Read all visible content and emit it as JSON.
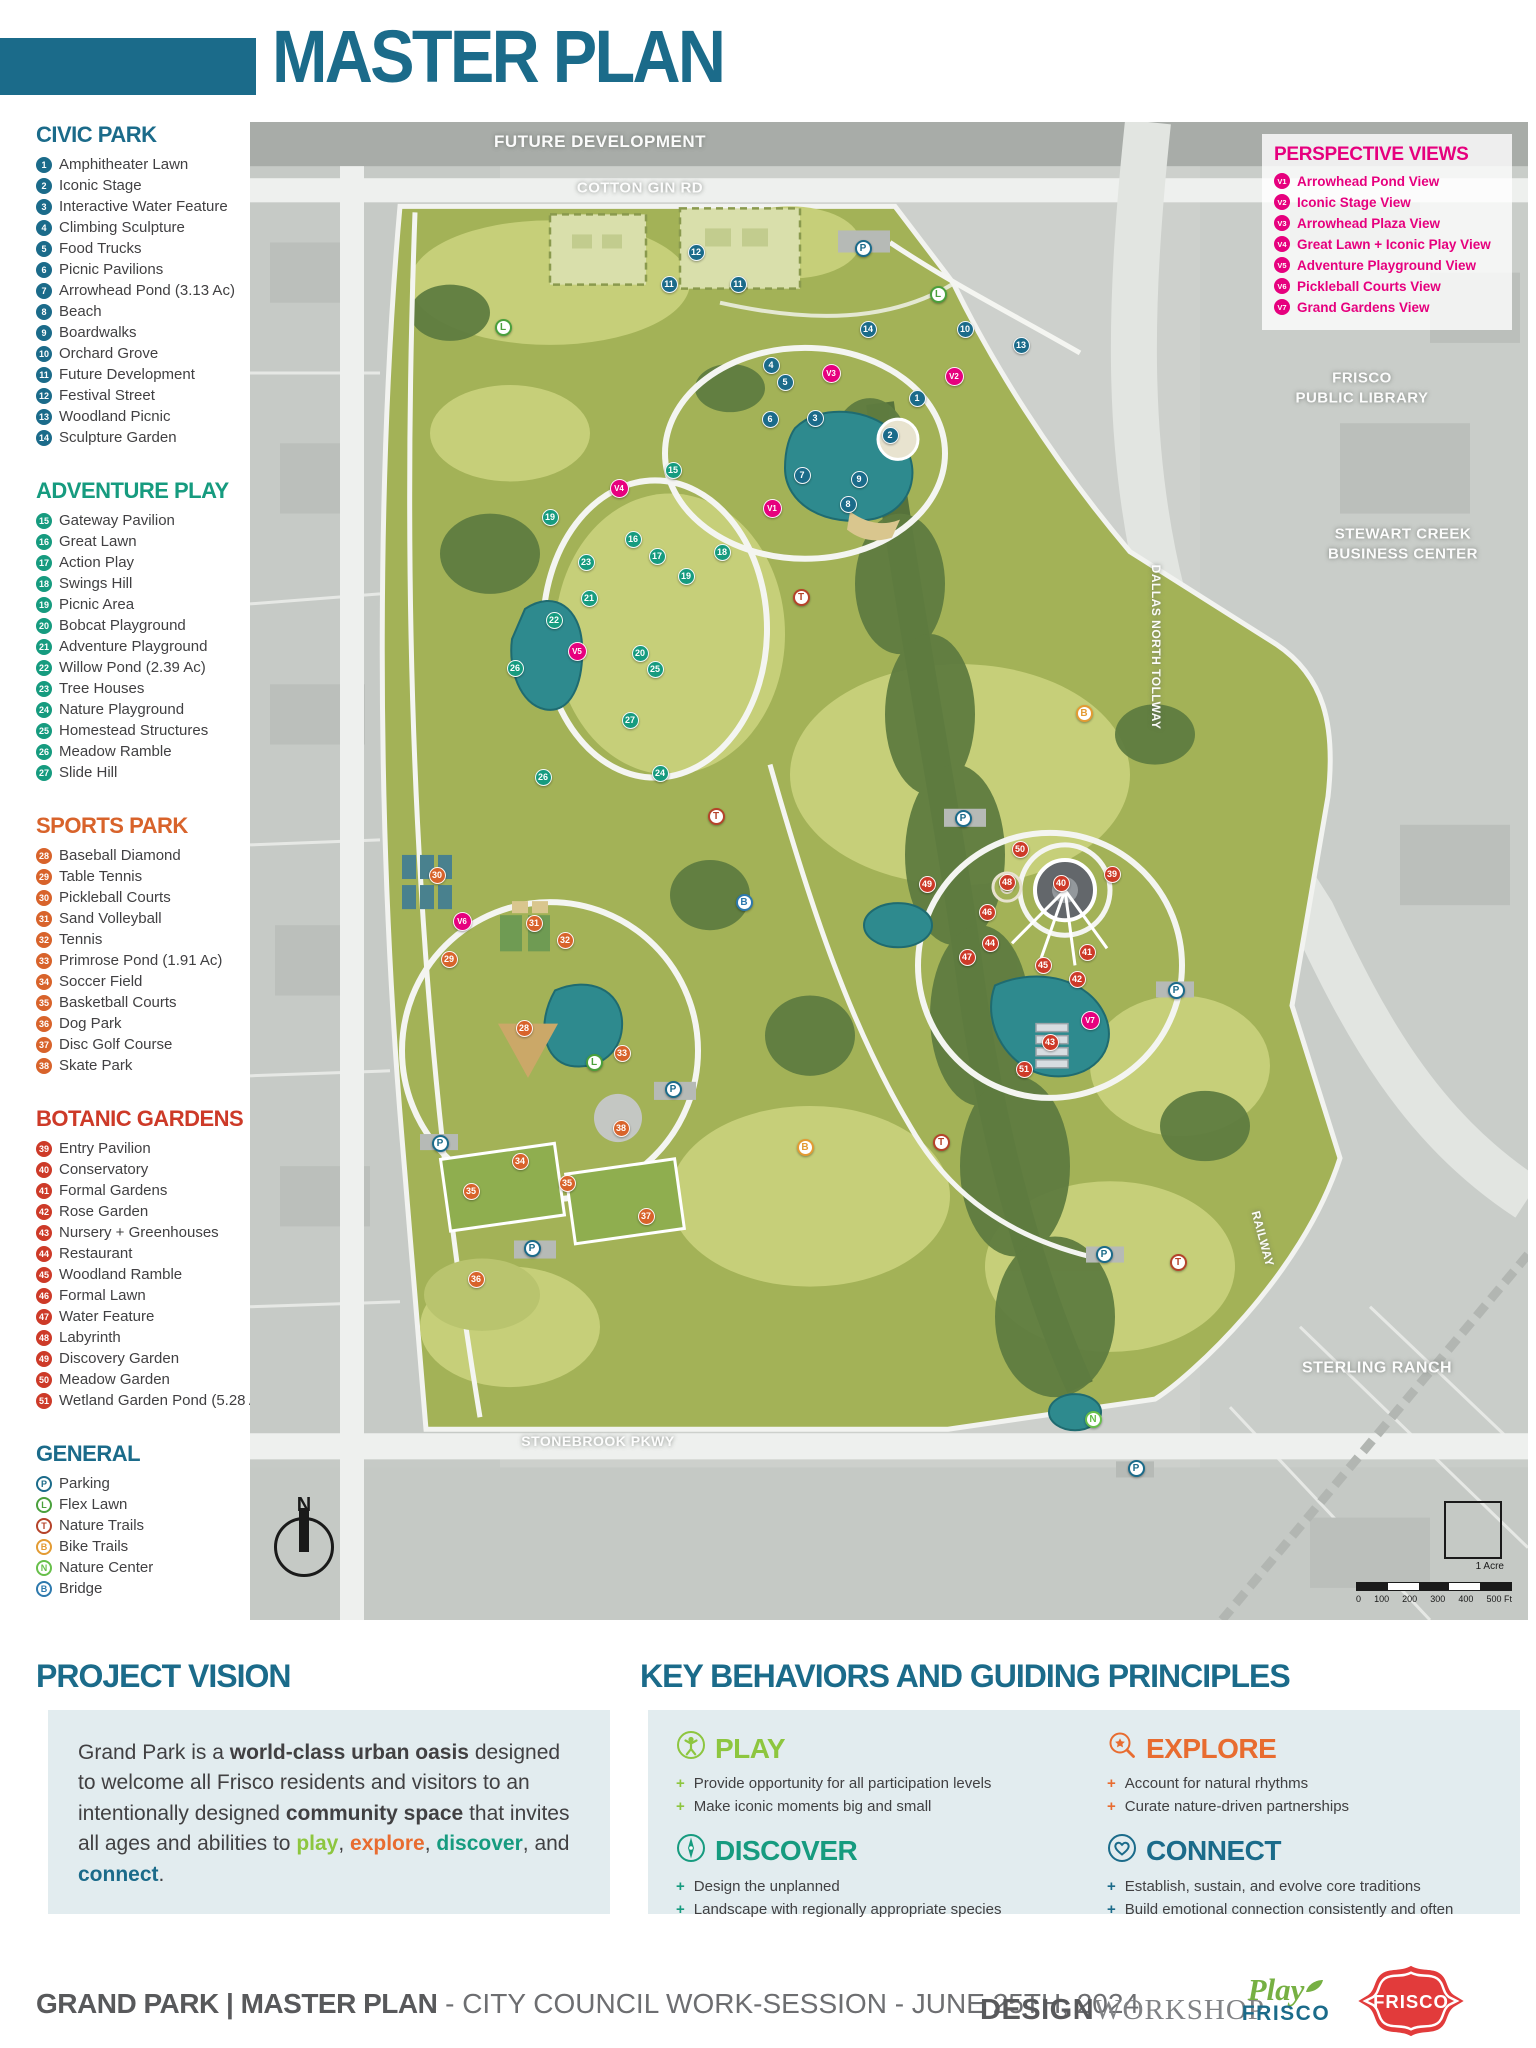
{
  "title": "MASTER PLAN",
  "legend": {
    "sections": [
      {
        "name": "CIVIC PARK",
        "color": "#1b6b8a",
        "items": [
          {
            "num": "1",
            "label": "Amphitheater Lawn"
          },
          {
            "num": "2",
            "label": "Iconic Stage"
          },
          {
            "num": "3",
            "label": "Interactive Water Feature"
          },
          {
            "num": "4",
            "label": "Climbing Sculpture"
          },
          {
            "num": "5",
            "label": "Food Trucks"
          },
          {
            "num": "6",
            "label": "Picnic Pavilions"
          },
          {
            "num": "7",
            "label": "Arrowhead Pond (3.13 Ac)"
          },
          {
            "num": "8",
            "label": "Beach"
          },
          {
            "num": "9",
            "label": "Boardwalks"
          },
          {
            "num": "10",
            "label": "Orchard Grove"
          },
          {
            "num": "11",
            "label": "Future Development"
          },
          {
            "num": "12",
            "label": "Festival Street"
          },
          {
            "num": "13",
            "label": "Woodland Picnic"
          },
          {
            "num": "14",
            "label": "Sculpture Garden"
          }
        ]
      },
      {
        "name": "ADVENTURE PLAY",
        "color": "#169b7f",
        "items": [
          {
            "num": "15",
            "label": "Gateway Pavilion"
          },
          {
            "num": "16",
            "label": "Great Lawn"
          },
          {
            "num": "17",
            "label": "Action Play"
          },
          {
            "num": "18",
            "label": "Swings Hill"
          },
          {
            "num": "19",
            "label": "Picnic Area"
          },
          {
            "num": "20",
            "label": "Bobcat Playground"
          },
          {
            "num": "21",
            "label": "Adventure Playground"
          },
          {
            "num": "22",
            "label": "Willow Pond (2.39 Ac)"
          },
          {
            "num": "23",
            "label": "Tree Houses"
          },
          {
            "num": "24",
            "label": "Nature Playground"
          },
          {
            "num": "25",
            "label": "Homestead Structures"
          },
          {
            "num": "26",
            "label": "Meadow Ramble"
          },
          {
            "num": "27",
            "label": "Slide Hill"
          }
        ]
      },
      {
        "name": "SPORTS PARK",
        "color": "#d8632b",
        "items": [
          {
            "num": "28",
            "label": "Baseball Diamond"
          },
          {
            "num": "29",
            "label": "Table Tennis"
          },
          {
            "num": "30",
            "label": "Pickleball Courts"
          },
          {
            "num": "31",
            "label": "Sand Volleyball"
          },
          {
            "num": "32",
            "label": "Tennis"
          },
          {
            "num": "33",
            "label": "Primrose Pond (1.91 Ac)"
          },
          {
            "num": "34",
            "label": "Soccer Field"
          },
          {
            "num": "35",
            "label": "Basketball Courts"
          },
          {
            "num": "36",
            "label": "Dog Park"
          },
          {
            "num": "37",
            "label": "Disc Golf Course"
          },
          {
            "num": "38",
            "label": "Skate Park"
          }
        ]
      },
      {
        "name": "BOTANIC GARDENS",
        "color": "#cd3a28",
        "items": [
          {
            "num": "39",
            "label": "Entry Pavilion"
          },
          {
            "num": "40",
            "label": "Conservatory"
          },
          {
            "num": "41",
            "label": "Formal Gardens"
          },
          {
            "num": "42",
            "label": "Rose Garden"
          },
          {
            "num": "43",
            "label": "Nursery + Greenhouses"
          },
          {
            "num": "44",
            "label": "Restaurant"
          },
          {
            "num": "45",
            "label": "Woodland Ramble"
          },
          {
            "num": "46",
            "label": "Formal Lawn"
          },
          {
            "num": "47",
            "label": "Water Feature"
          },
          {
            "num": "48",
            "label": "Labyrinth"
          },
          {
            "num": "49",
            "label": "Discovery Garden"
          },
          {
            "num": "50",
            "label": "Meadow Garden"
          },
          {
            "num": "51",
            "label": "Wetland Garden Pond (5.28 Ac)"
          }
        ]
      },
      {
        "name": "GENERAL",
        "color": "#1b6b8a",
        "style": "outline",
        "items": [
          {
            "num": "P",
            "label": "Parking",
            "color": "#1b6b8a",
            "icon": "parking-icon"
          },
          {
            "num": "L",
            "label": "Flex Lawn",
            "color": "#4aa03c",
            "icon": "flex-lawn-icon"
          },
          {
            "num": "T",
            "label": "Nature Trails",
            "color": "#b5432a",
            "icon": "nature-trails-icon"
          },
          {
            "num": "B",
            "label": "Bike Trails",
            "color": "#e39b33",
            "icon": "bike-trails-icon"
          },
          {
            "num": "N",
            "label": "Nature Center",
            "color": "#67bf4a",
            "icon": "nature-center-icon"
          },
          {
            "num": "B",
            "label": "Bridge",
            "color": "#2d79ad",
            "icon": "bridge-icon"
          }
        ]
      }
    ]
  },
  "perspective_views": {
    "title": "PERSPECTIVE VIEWS",
    "color": "#e6007e",
    "items": [
      {
        "num": "V1",
        "label": "Arrowhead Pond View"
      },
      {
        "num": "V2",
        "label": "Iconic Stage View"
      },
      {
        "num": "V3",
        "label": "Arrowhead Plaza View"
      },
      {
        "num": "V4",
        "label": "Great Lawn + Iconic Play View"
      },
      {
        "num": "V5",
        "label": "Adventure Playground View"
      },
      {
        "num": "V6",
        "label": "Pickleball Courts View"
      },
      {
        "num": "V7",
        "label": "Grand Gardens View"
      }
    ]
  },
  "map": {
    "labels": [
      {
        "lines": [
          "FUTURE DEVELOPMENT"
        ],
        "x": 350,
        "y": 20,
        "size": 17,
        "rot": 0
      },
      {
        "lines": [
          "COTTON GIN RD"
        ],
        "x": 390,
        "y": 66,
        "size": 15,
        "rot": 0
      },
      {
        "lines": [
          "FRISCO",
          "PUBLIC LIBRARY"
        ],
        "x": 1112,
        "y": 266,
        "size": 15,
        "rot": 0
      },
      {
        "lines": [
          "STEWART CREEK",
          "BUSINESS CENTER"
        ],
        "x": 1153,
        "y": 422,
        "size": 15,
        "rot": 0
      },
      {
        "lines": [
          "DALLAS NORTH TOLLWAY"
        ],
        "x": 905,
        "y": 525,
        "size": 12,
        "rot": 90
      },
      {
        "lines": [
          "RAILWAY"
        ],
        "x": 1012,
        "y": 1117,
        "size": 12,
        "rot": 75
      },
      {
        "lines": [
          "STERLING RANCH"
        ],
        "x": 1127,
        "y": 1247,
        "size": 16,
        "rot": 0
      },
      {
        "lines": [
          "STONEBROOK PKWY"
        ],
        "x": 348,
        "y": 1319,
        "size": 14,
        "rot": 0
      }
    ],
    "markers": [
      {
        "n": "1",
        "t": "c",
        "x": 667,
        "y": 276
      },
      {
        "n": "2",
        "t": "c",
        "x": 640,
        "y": 313
      },
      {
        "n": "3",
        "t": "c",
        "x": 565,
        "y": 296
      },
      {
        "n": "4",
        "t": "c",
        "x": 521,
        "y": 243
      },
      {
        "n": "5",
        "t": "c",
        "x": 535,
        "y": 260
      },
      {
        "n": "6",
        "t": "c",
        "x": 520,
        "y": 297
      },
      {
        "n": "7",
        "t": "c",
        "x": 552,
        "y": 353
      },
      {
        "n": "8",
        "t": "c",
        "x": 598,
        "y": 382
      },
      {
        "n": "9",
        "t": "c",
        "x": 609,
        "y": 357
      },
      {
        "n": "10",
        "t": "c",
        "x": 715,
        "y": 207
      },
      {
        "n": "11",
        "t": "c",
        "x": 419,
        "y": 162
      },
      {
        "n": "11",
        "t": "c",
        "x": 488,
        "y": 162
      },
      {
        "n": "12",
        "t": "c",
        "x": 446,
        "y": 130
      },
      {
        "n": "13",
        "t": "c",
        "x": 771,
        "y": 223
      },
      {
        "n": "14",
        "t": "c",
        "x": 618,
        "y": 207
      },
      {
        "n": "15",
        "t": "a",
        "x": 423,
        "y": 348
      },
      {
        "n": "16",
        "t": "a",
        "x": 383,
        "y": 417
      },
      {
        "n": "17",
        "t": "a",
        "x": 407,
        "y": 434
      },
      {
        "n": "18",
        "t": "a",
        "x": 472,
        "y": 430
      },
      {
        "n": "19",
        "t": "a",
        "x": 300,
        "y": 395
      },
      {
        "n": "19",
        "t": "a",
        "x": 436,
        "y": 454
      },
      {
        "n": "20",
        "t": "a",
        "x": 390,
        "y": 531
      },
      {
        "n": "21",
        "t": "a",
        "x": 339,
        "y": 476
      },
      {
        "n": "22",
        "t": "a",
        "x": 304,
        "y": 498
      },
      {
        "n": "23",
        "t": "a",
        "x": 336,
        "y": 440
      },
      {
        "n": "24",
        "t": "a",
        "x": 410,
        "y": 651
      },
      {
        "n": "25",
        "t": "a",
        "x": 405,
        "y": 547
      },
      {
        "n": "26",
        "t": "a",
        "x": 265,
        "y": 546
      },
      {
        "n": "26",
        "t": "a",
        "x": 293,
        "y": 655
      },
      {
        "n": "27",
        "t": "a",
        "x": 380,
        "y": 598
      },
      {
        "n": "28",
        "t": "s",
        "x": 274,
        "y": 906
      },
      {
        "n": "29",
        "t": "s",
        "x": 199,
        "y": 837
      },
      {
        "n": "30",
        "t": "s",
        "x": 187,
        "y": 753
      },
      {
        "n": "31",
        "t": "s",
        "x": 284,
        "y": 801
      },
      {
        "n": "32",
        "t": "s",
        "x": 315,
        "y": 818
      },
      {
        "n": "33",
        "t": "s",
        "x": 372,
        "y": 931
      },
      {
        "n": "34",
        "t": "s",
        "x": 270,
        "y": 1039
      },
      {
        "n": "35",
        "t": "s",
        "x": 221,
        "y": 1069
      },
      {
        "n": "35",
        "t": "s",
        "x": 317,
        "y": 1061
      },
      {
        "n": "36",
        "t": "s",
        "x": 226,
        "y": 1157
      },
      {
        "n": "37",
        "t": "s",
        "x": 396,
        "y": 1094
      },
      {
        "n": "38",
        "t": "s",
        "x": 371,
        "y": 1006
      },
      {
        "n": "39",
        "t": "b",
        "x": 862,
        "y": 752
      },
      {
        "n": "40",
        "t": "b",
        "x": 811,
        "y": 761
      },
      {
        "n": "41",
        "t": "b",
        "x": 837,
        "y": 830
      },
      {
        "n": "42",
        "t": "b",
        "x": 827,
        "y": 857
      },
      {
        "n": "43",
        "t": "b",
        "x": 800,
        "y": 920
      },
      {
        "n": "44",
        "t": "b",
        "x": 740,
        "y": 821
      },
      {
        "n": "45",
        "t": "b",
        "x": 793,
        "y": 843
      },
      {
        "n": "46",
        "t": "b",
        "x": 737,
        "y": 790
      },
      {
        "n": "47",
        "t": "b",
        "x": 717,
        "y": 835
      },
      {
        "n": "48",
        "t": "b",
        "x": 757,
        "y": 760
      },
      {
        "n": "49",
        "t": "b",
        "x": 677,
        "y": 762
      },
      {
        "n": "50",
        "t": "b",
        "x": 770,
        "y": 727
      },
      {
        "n": "51",
        "t": "b",
        "x": 774,
        "y": 947
      },
      {
        "n": "V1",
        "t": "v",
        "x": 522,
        "y": 386
      },
      {
        "n": "V2",
        "t": "v",
        "x": 704,
        "y": 254
      },
      {
        "n": "V3",
        "t": "v",
        "x": 581,
        "y": 251
      },
      {
        "n": "V4",
        "t": "v",
        "x": 369,
        "y": 366
      },
      {
        "n": "V5",
        "t": "v",
        "x": 327,
        "y": 529
      },
      {
        "n": "V6",
        "t": "v",
        "x": 212,
        "y": 799
      },
      {
        "n": "V7",
        "t": "v",
        "x": 840,
        "y": 898
      },
      {
        "n": "P",
        "t": "P",
        "x": 613,
        "y": 126
      },
      {
        "n": "P",
        "t": "P",
        "x": 713,
        "y": 696
      },
      {
        "n": "P",
        "t": "P",
        "x": 423,
        "y": 967
      },
      {
        "n": "P",
        "t": "P",
        "x": 282,
        "y": 1126
      },
      {
        "n": "P",
        "t": "P",
        "x": 190,
        "y": 1021
      },
      {
        "n": "P",
        "t": "P",
        "x": 926,
        "y": 868
      },
      {
        "n": "P",
        "t": "P",
        "x": 854,
        "y": 1132
      },
      {
        "n": "P",
        "t": "P",
        "x": 886,
        "y": 1346
      },
      {
        "n": "L",
        "t": "L",
        "x": 253,
        "y": 205
      },
      {
        "n": "L",
        "t": "L",
        "x": 688,
        "y": 172
      },
      {
        "n": "L",
        "t": "L",
        "x": 344,
        "y": 940
      },
      {
        "n": "T",
        "t": "T",
        "x": 551,
        "y": 475
      },
      {
        "n": "T",
        "t": "T",
        "x": 466,
        "y": 694
      },
      {
        "n": "T",
        "t": "T",
        "x": 691,
        "y": 1020
      },
      {
        "n": "T",
        "t": "T",
        "x": 928,
        "y": 1140
      },
      {
        "n": "B",
        "t": "Bk",
        "x": 834,
        "y": 591
      },
      {
        "n": "B",
        "t": "Bk",
        "x": 555,
        "y": 1025
      },
      {
        "n": "B",
        "t": "Bd",
        "x": 494,
        "y": 780
      },
      {
        "n": "N",
        "t": "N",
        "x": 843,
        "y": 1297
      }
    ],
    "scale": {
      "ticks": [
        "0",
        "100",
        "200",
        "300",
        "400",
        "500 Ft"
      ],
      "acre_label": "1 Acre"
    },
    "compass_label": "N"
  },
  "project_vision": {
    "title": "PROJECT VISION",
    "segments": [
      {
        "t": "Grand Park is a "
      },
      {
        "t": "world-class urban oasis",
        "b": 1
      },
      {
        "t": " designed to welcome all Frisco residents and visitors to an intentionally designed "
      },
      {
        "t": "community space",
        "b": 1
      },
      {
        "t": " that invites all ages and abilities to "
      },
      {
        "t": "play",
        "b": 1,
        "c": "#8dc63f"
      },
      {
        "t": ", "
      },
      {
        "t": "explore",
        "b": 1,
        "c": "#e86c30"
      },
      {
        "t": ", "
      },
      {
        "t": "discover",
        "b": 1,
        "c": "#169b7f"
      },
      {
        "t": ", and "
      },
      {
        "t": "connect",
        "b": 1,
        "c": "#1b6b8a"
      },
      {
        "t": "."
      }
    ]
  },
  "key_behaviors": {
    "title": "KEY BEHAVIORS AND GUIDING PRINCIPLES",
    "cards": [
      {
        "name": "PLAY",
        "color": "#8dc63f",
        "icon": "play-icon",
        "bullets": [
          "Provide opportunity for all participation levels",
          "Make iconic moments big and small"
        ]
      },
      {
        "name": "EXPLORE",
        "color": "#e86c30",
        "icon": "explore-icon",
        "bullets": [
          "Account for natural rhythms",
          "Curate nature-driven partnerships"
        ]
      },
      {
        "name": "DISCOVER",
        "color": "#169b7f",
        "icon": "discover-icon",
        "bullets": [
          "Design the unplanned",
          "Landscape with regionally appropriate species"
        ]
      },
      {
        "name": "CONNECT",
        "color": "#1b6b8a",
        "icon": "connect-icon",
        "bullets": [
          "Establish, sustain, and evolve core traditions",
          "Build emotional connection consistently and often"
        ]
      }
    ]
  },
  "footer": {
    "project": "GRAND PARK | MASTER PLAN",
    "session": " - CITY COUNCIL WORK-SESSION - JUNE 25TH, 2024",
    "designworkshop_bold": "DESIGN",
    "designworkshop_serif": "WORKSHOP",
    "playfrisco_script": "Play",
    "playfrisco_word": "FRISCO",
    "frisco_badge": "FRISCO"
  }
}
